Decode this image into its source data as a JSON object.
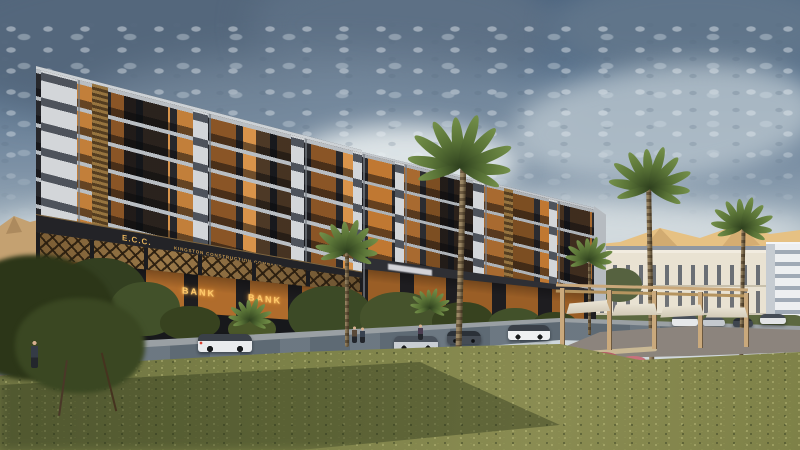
{
  "scene": {
    "alt": "Dusk architectural rendering of a modern dark-facade residential complex with lit apartments, gold lattice retail level and bank branches, fronted by palm trees, a lawn, a wet street with cars and a pergola plaza; golden mountains and classical buildings in the background under a dramatic cloudy sky"
  },
  "building": {
    "logo_sign": "E.C.C.",
    "company_sign": "KINGSTON CONSTRUCTION COMPANY",
    "tenant_signs": [
      "BANK",
      "BANK"
    ]
  },
  "palette": {
    "sky_top": "#47617e",
    "sky_horizon": "#d9dee1",
    "facade_dark": "#33343a",
    "facade_light": "#d3d6d9",
    "window_glow": "#d8934a",
    "sign_gold": "#e5b35c",
    "bank_glow": "#ffca6a",
    "mountain_gold": "#e6c183",
    "grass_olive": "#7c8148",
    "road_gray": "#5e6a74",
    "pergola_wood": "#c9ab7e",
    "canopy_white": "#f1ebdc"
  }
}
